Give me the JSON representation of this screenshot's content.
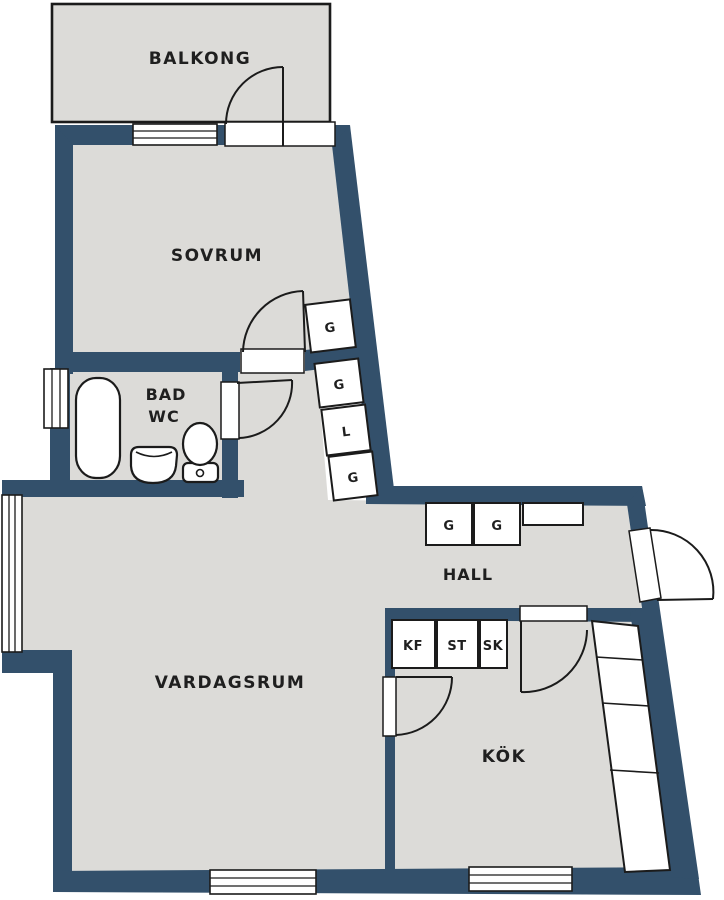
{
  "title": "Apartment floor plan",
  "colors": {
    "wall": "#33506b",
    "floor": "#dcdbd8",
    "line": "#1b1b1b",
    "text": "#1f1f1f",
    "background": "#ffffff"
  },
  "rooms": {
    "balcony": "BALKONG",
    "bedroom": "SOVRUM",
    "bath_line1": "BAD",
    "bath_line2": "WC",
    "living": "VARDAGSRUM",
    "hall": "HALL",
    "kitchen": "KÖK"
  },
  "closets": {
    "bedroom_g": "G",
    "stack": [
      "G",
      "L",
      "G"
    ],
    "hall": [
      "G",
      "G"
    ],
    "kitchen": [
      "KF",
      "ST",
      "SK"
    ]
  }
}
